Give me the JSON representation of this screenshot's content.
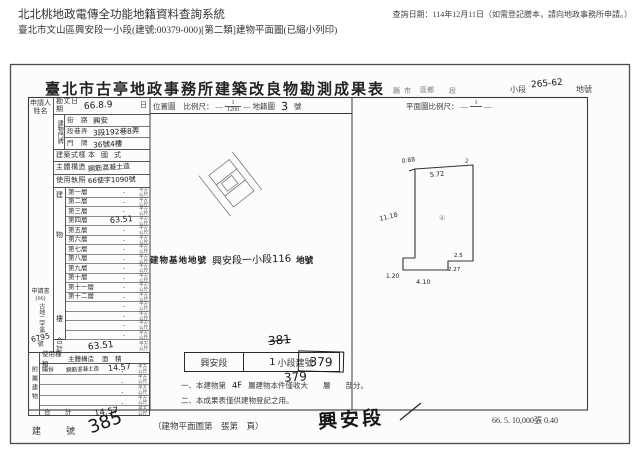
{
  "header": {
    "system_title": "北北桃地政電傳全功能地籍資料查詢系統",
    "query_date": "查詢日期：114年12月11日（如需登記謄本，請向地政事務所申請。）",
    "subtitle": "臺北市文山區興安段一小段(建號:00379-000)[第二類]建物平面圖(已縮小列印)"
  },
  "doc": {
    "title": "臺北市古亭地政事務所建築改良物勘測成果表",
    "title_row": {
      "county": "縣",
      "city": "市",
      "district": "區鄉",
      "section": "段",
      "subsection_label": "小段",
      "subsection_hw": "265-62",
      "lot_label": "地號"
    },
    "applicant_label": "申請人姓名",
    "docref": {
      "book": "申請書",
      "year": "(66)",
      "prefix": "古地二字第",
      "number": "6795",
      "suffix": "號"
    },
    "survey": {
      "label": "勘丈日期",
      "value": "66.8.9",
      "unit": "日"
    },
    "address": {
      "label": "建物門牌",
      "rows": [
        {
          "label": "街　路",
          "value": "興安"
        },
        {
          "label": "段巷弄",
          "value": "3段192巷8弄"
        },
        {
          "label": "門　牌",
          "value": "36號4樓"
        }
      ]
    },
    "style": {
      "label": "建築式樣",
      "value": "本國式"
    },
    "structure": {
      "label": "主體構造",
      "value": "鋼筋混凝土造"
    },
    "license": {
      "label": "使用執照",
      "value": "66使字1090號"
    },
    "floors": {
      "side": [
        "建",
        "物",
        "樓"
      ],
      "dot": "．",
      "unit": "平方公尺",
      "rows": [
        {
          "label": "第一層",
          "value": ""
        },
        {
          "label": "第二層",
          "value": ""
        },
        {
          "label": "第三層",
          "value": ""
        },
        {
          "label": "第四層",
          "value": "63.51"
        },
        {
          "label": "第五層",
          "value": ""
        },
        {
          "label": "第六層",
          "value": ""
        },
        {
          "label": "第七層",
          "value": ""
        },
        {
          "label": "第八層",
          "value": ""
        },
        {
          "label": "第九層",
          "value": ""
        },
        {
          "label": "第十層",
          "value": ""
        },
        {
          "label": "第十一層",
          "value": ""
        },
        {
          "label": "第十二層",
          "value": ""
        },
        {
          "label": "",
          "value": ""
        },
        {
          "label": "",
          "value": ""
        },
        {
          "label": "",
          "value": ""
        },
        {
          "label": "",
          "value": ""
        }
      ]
    },
    "total": {
      "label": "合　計",
      "value": "63.51"
    },
    "attached": {
      "side": "附屬建物",
      "headers": {
        "use": "使用種類",
        "structure": "主體構造",
        "area": "面　積"
      },
      "dot": "．",
      "unit": "平方公尺",
      "rows": [
        {
          "use": "陽台",
          "structure": "鋼筋混凝土造",
          "area": "14.57"
        },
        {
          "use": "",
          "structure": "",
          "area": ""
        },
        {
          "use": "",
          "structure": "",
          "area": ""
        },
        {
          "use": "",
          "structure": "",
          "area": ""
        }
      ],
      "total": {
        "label": "合　計",
        "value": "14.57"
      }
    },
    "building_no": {
      "label": "建　號",
      "value": "385"
    },
    "map": {
      "panel_label": "位置圖",
      "scale_label": "比例尺：",
      "dash": "—",
      "scale_num": "1",
      "scale_den": "1200",
      "sheet_label": "地籍圖",
      "sheet_no": "3",
      "sheet_suffix": "號",
      "site_label": "建物基地地號",
      "site_value": "興安段一小段116",
      "site_suffix": "地號"
    },
    "plan": {
      "header": "平面圖比例尺：",
      "dash": "—",
      "scale_num": "1",
      "dims": {
        "top_step": "0.88",
        "top": "5.72",
        "extra": "2",
        "left": "11.18",
        "tab": "1.20",
        "bottom": "4.10",
        "step_w": "2.5",
        "step_h": "2.27",
        "mark": "④"
      }
    },
    "regno": {
      "crossed": "381",
      "boxed": "379",
      "below": "379",
      "box_section": "興安段",
      "box_hw": "1",
      "box_label": "小段建號"
    },
    "notes": {
      "n1_pre": "一、本建物第",
      "n1_hw": "4F",
      "n1_post": "層建物本件僅收大　　層　　部分。",
      "n2": "二、本成果表僅供建物登記之用。"
    },
    "footer": {
      "caption": "（建物平面圖第　張第　頁）",
      "section_hw": "興安段",
      "print_code": "66. 5. 10,000張 0.40"
    }
  }
}
